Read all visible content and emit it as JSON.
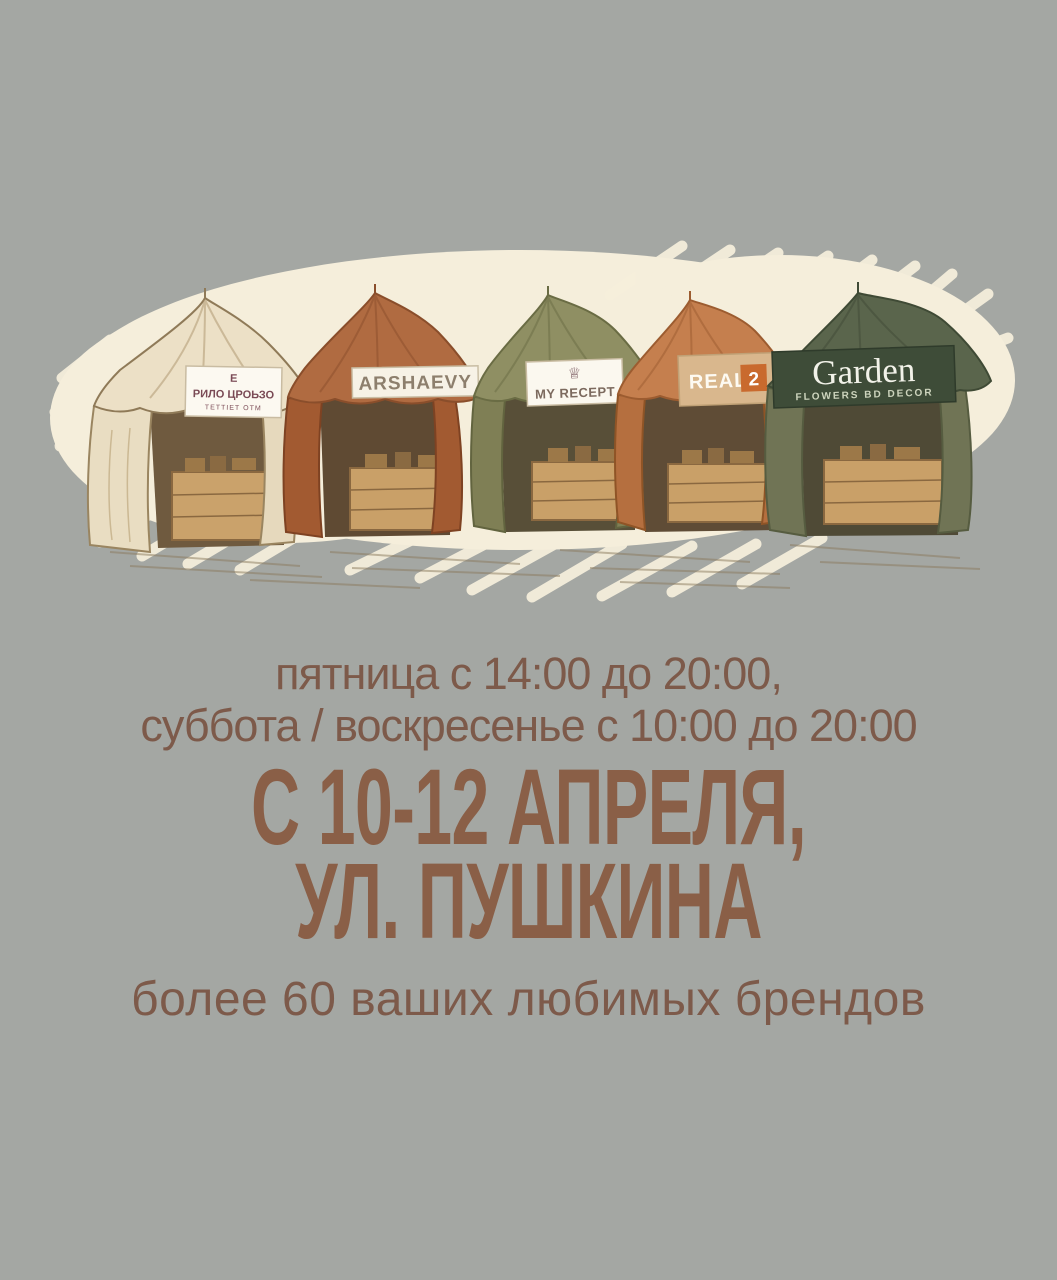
{
  "poster": {
    "background_color": "#a4a7a3",
    "blob_color": "#f5eedb",
    "text_color": "#7d5a4a",
    "heading_color": "#8a5f47",
    "schedule_line1": "пятница с 14:00 до 20:00,",
    "schedule_line2": "суббота / воскресенье с 10:00 до 20:00",
    "heading_line1": "С 10-12 АПРЕЛЯ,",
    "heading_line2": "УЛ. ПУШКИНА",
    "subheading": "более 60 ваших любимых брендов",
    "tents": [
      {
        "name": "cream-tent",
        "banner_top": "Е",
        "banner_main": "РИЛО ЦРОЬЗО",
        "banner_sub": "ТЕТТІЕТ ОТМ"
      },
      {
        "name": "rust-tent",
        "banner": "ARSHAEVY"
      },
      {
        "name": "olive-tent",
        "banner": "MY RECEPT",
        "icon": "crown-icon"
      },
      {
        "name": "orange-tent",
        "banner": "REAL",
        "badge": "2"
      },
      {
        "name": "green-tent",
        "banner": "Garden",
        "subtitle": "FLOWERS BD DECOR"
      }
    ]
  }
}
